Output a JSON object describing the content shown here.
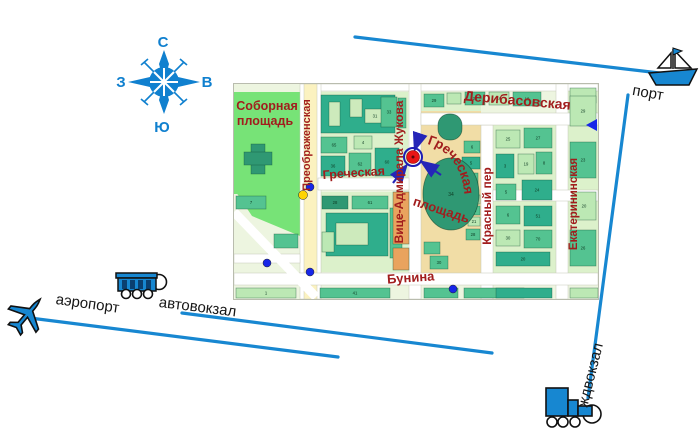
{
  "colors": {
    "route_blue": "#1787d1",
    "compass_blue": "#1080cf",
    "street_label_red": "#a11d1d",
    "marker_red": "#e81515",
    "marker_ring_blue": "#1c1cb4",
    "stop_dot_blue": "#1726e8",
    "stop_dot_yellow": "#ffd400",
    "square_beige": "#f1dda6",
    "park_green": "#77e377"
  },
  "compass": {
    "north": "С",
    "south": "Ю",
    "west": "З",
    "east": "В"
  },
  "transport": {
    "port": {
      "label": "порт",
      "icon": "ship-icon"
    },
    "airport": {
      "label": "аэропорт",
      "icon": "plane-icon"
    },
    "bus_station": {
      "label": "автовокзал",
      "icon": "bus-icon"
    },
    "rail_station": {
      "label": "ждвокзал",
      "icon": "train-icon"
    }
  },
  "connectors": [
    {
      "name": "port-line",
      "x1": 355,
      "y1": 37,
      "x2": 668,
      "y2": 74
    },
    {
      "name": "rail-line",
      "x1": 628,
      "y1": 95,
      "x2": 588,
      "y2": 398
    },
    {
      "name": "airport-line",
      "x1": 30,
      "y1": 318,
      "x2": 338,
      "y2": 357
    },
    {
      "name": "bus-line",
      "x1": 182,
      "y1": 313,
      "x2": 492,
      "y2": 353
    }
  ],
  "map": {
    "areas": [
      {
        "x": 0,
        "y": 0,
        "w": 364,
        "h": 215,
        "c": "#edf5e0"
      },
      {
        "x": 0,
        "y": 8,
        "w": 72,
        "h": 102,
        "c": "#77e377"
      },
      {
        "x": 84,
        "y": 8,
        "w": 90,
        "h": 88,
        "c": "#dcf1cb"
      },
      {
        "x": 84,
        "y": 108,
        "w": 90,
        "h": 80,
        "c": "#dcf1cb"
      },
      {
        "x": 187,
        "y": 8,
        "w": 60,
        "h": 19,
        "c": "#dcf1cb"
      },
      {
        "x": 187,
        "y": 27,
        "w": 60,
        "h": 163,
        "c": "#f1dda6"
      },
      {
        "x": 259,
        "y": 41,
        "w": 63,
        "h": 148,
        "c": "#dcf1cb"
      },
      {
        "x": 334,
        "y": 0,
        "w": 30,
        "h": 189,
        "c": "#dcf1cb"
      }
    ],
    "polygons": [
      {
        "points": "2,108 66,108 66,152 18,132",
        "c": "#77e377"
      }
    ],
    "roads": [
      {
        "x": 84,
        "y": 0,
        "w": 280,
        "h": 7
      },
      {
        "x": 66,
        "y": 0,
        "w": 21,
        "h": 215
      },
      {
        "x": 70,
        "y": 0,
        "w": 13,
        "h": 215,
        "c": "#fbf2c0"
      },
      {
        "x": 175,
        "y": 0,
        "w": 12,
        "h": 215
      },
      {
        "x": 247,
        "y": 41,
        "w": 12,
        "h": 174
      },
      {
        "x": 322,
        "y": 0,
        "w": 12,
        "h": 215
      },
      {
        "x": 187,
        "y": 29,
        "w": 177,
        "h": 12
      },
      {
        "x": 84,
        "y": 94,
        "w": 91,
        "h": 12
      },
      {
        "x": 259,
        "y": 106,
        "w": 105,
        "h": 11
      },
      {
        "x": 0,
        "y": 189,
        "w": 364,
        "h": 12
      },
      {
        "x": 0,
        "y": 170,
        "w": 66,
        "h": 9
      },
      {
        "diag": true,
        "x1": 0,
        "y1": 128,
        "x2": 82,
        "y2": 213,
        "sw": 9
      }
    ],
    "buildings": [
      [
        87,
        11,
        74,
        38,
        "#2fae8c",
        "38"
      ],
      [
        95,
        18,
        11,
        24,
        "#cdeabc",
        ""
      ],
      [
        116,
        15,
        12,
        18,
        "#cdeabc",
        ""
      ],
      [
        131,
        25,
        20,
        14,
        "#cdeabc",
        "31"
      ],
      [
        147,
        13,
        16,
        30,
        "#54c391",
        "33"
      ],
      [
        120,
        52,
        18,
        13,
        "#bce8b4",
        "4"
      ],
      [
        87,
        53,
        26,
        16,
        "#54c391",
        "65"
      ],
      [
        87,
        72,
        24,
        20,
        "#2fae8c",
        "36"
      ],
      [
        115,
        69,
        22,
        22,
        "#54c391",
        "62"
      ],
      [
        141,
        64,
        24,
        28,
        "#2fae8c",
        "60"
      ],
      [
        164,
        14,
        8,
        30,
        "#54c391",
        ""
      ],
      [
        88,
        112,
        26,
        13,
        "#2f9873",
        "28"
      ],
      [
        118,
        112,
        36,
        13,
        "#54c391",
        "61"
      ],
      [
        92,
        129,
        62,
        43,
        "#2fae8c",
        "42"
      ],
      [
        102,
        139,
        32,
        22,
        "#cdeabc",
        ""
      ],
      [
        88,
        148,
        12,
        20,
        "#bce8b4",
        ""
      ],
      [
        156,
        124,
        12,
        50,
        "#54c391",
        "16"
      ],
      [
        2,
        112,
        30,
        13,
        "#54c391",
        "7"
      ],
      [
        40,
        150,
        24,
        14,
        "#54c391",
        ""
      ],
      [
        190,
        10,
        20,
        13,
        "#54c391",
        "29"
      ],
      [
        213,
        9,
        14,
        11,
        "#bce8b4",
        ""
      ],
      [
        231,
        8,
        20,
        13,
        "#54c391",
        "22"
      ],
      [
        255,
        8,
        20,
        13,
        "#bce8b4",
        "16"
      ],
      [
        279,
        8,
        28,
        14,
        "#54c391",
        "10"
      ],
      [
        336,
        4,
        26,
        15,
        "#bce8b4",
        ""
      ],
      [
        230,
        57,
        16,
        12,
        "#54c391",
        "6"
      ],
      [
        228,
        73,
        18,
        12,
        "#2fae8c",
        "5"
      ],
      [
        224,
        89,
        20,
        12,
        "#54c391",
        "44"
      ],
      [
        234,
        111,
        12,
        9,
        "#bce8b4",
        "12"
      ],
      [
        234,
        122,
        12,
        9,
        "#54c391",
        "14"
      ],
      [
        234,
        133,
        12,
        9,
        "#bce8b4",
        "21"
      ],
      [
        232,
        145,
        14,
        11,
        "#54c391",
        "28"
      ],
      [
        190,
        158,
        16,
        12,
        "#54c391",
        ""
      ],
      [
        196,
        172,
        18,
        13,
        "#54c391",
        "30"
      ],
      [
        159,
        108,
        16,
        52,
        "#e9a35e",
        "2"
      ],
      [
        159,
        164,
        16,
        22,
        "#e9a35e",
        ""
      ],
      [
        262,
        46,
        24,
        18,
        "#bce8b4",
        "25"
      ],
      [
        290,
        44,
        28,
        20,
        "#54c391",
        "27"
      ],
      [
        262,
        70,
        18,
        24,
        "#2fae8c",
        "3"
      ],
      [
        284,
        70,
        16,
        20,
        "#bce8b4",
        "19"
      ],
      [
        302,
        68,
        16,
        22,
        "#54c391",
        "8"
      ],
      [
        262,
        100,
        20,
        16,
        "#54c391",
        "5"
      ],
      [
        288,
        96,
        30,
        20,
        "#2fae8c",
        "24"
      ],
      [
        262,
        122,
        24,
        18,
        "#54c391",
        "6"
      ],
      [
        290,
        122,
        28,
        20,
        "#2fae8c",
        "51"
      ],
      [
        262,
        146,
        24,
        16,
        "#bce8b4",
        "30"
      ],
      [
        290,
        146,
        28,
        18,
        "#54c391",
        "70"
      ],
      [
        262,
        168,
        54,
        14,
        "#2fae8c",
        "20"
      ],
      [
        336,
        12,
        26,
        30,
        "#bce8b4",
        "29"
      ],
      [
        336,
        58,
        26,
        36,
        "#54c391",
        "23"
      ],
      [
        338,
        108,
        24,
        28,
        "#bce8b4",
        "20"
      ],
      [
        336,
        146,
        26,
        36,
        "#54c391",
        "26"
      ],
      [
        2,
        204,
        60,
        10,
        "#bce8b4",
        "1"
      ],
      [
        86,
        204,
        70,
        10,
        "#54c391",
        "41"
      ],
      [
        190,
        204,
        34,
        10,
        "#54c391",
        ""
      ],
      [
        230,
        204,
        60,
        10,
        "#54c391",
        ""
      ],
      [
        262,
        204,
        56,
        10,
        "#2fae8c",
        ""
      ],
      [
        336,
        204,
        28,
        10,
        "#bce8b4",
        ""
      ],
      [
        17,
        60,
        14,
        30,
        "#2f9873",
        "3"
      ],
      [
        10,
        68,
        28,
        13,
        "#2f9873",
        ""
      ]
    ],
    "shapes": {
      "stadium": {
        "x": 204,
        "y": 30,
        "w": 24,
        "h": 26,
        "rx": 11,
        "c": "#2f9873"
      },
      "oval": {
        "cx": 217,
        "cy": 110,
        "rx": 28,
        "ry": 36,
        "c": "#2f9873",
        "n": "34"
      }
    },
    "dots": [
      {
        "x": 76,
        "y": 103,
        "r": 4,
        "c": "#1726e8"
      },
      {
        "x": 69,
        "y": 111,
        "r": 4.5,
        "c": "#ffd400"
      },
      {
        "x": 33,
        "y": 179,
        "r": 4,
        "c": "#1726e8"
      },
      {
        "x": 76,
        "y": 188,
        "r": 4,
        "c": "#1726e8"
      },
      {
        "x": 219,
        "y": 205,
        "r": 4,
        "c": "#1726e8"
      }
    ],
    "direction_triangle": {
      "points": "352,41 363,35 363,47",
      "c": "#1726e8"
    },
    "marker": {
      "cx": 179,
      "cy": 73,
      "fill": "#e81515",
      "ring": "#1c1cb4"
    },
    "marker_arrows": [
      [
        186,
        50,
        181,
        65
      ],
      [
        159,
        99,
        172,
        82
      ],
      [
        207,
        91,
        188,
        78
      ]
    ],
    "street_labels": [
      {
        "t": "Соборная",
        "x": 33,
        "y": 26,
        "s": 12.5,
        "r": 0
      },
      {
        "t": "площадь",
        "x": 31,
        "y": 41,
        "s": 12.5,
        "r": 0
      },
      {
        "t": "Преображенская",
        "x": 76,
        "y": 61,
        "s": 11,
        "r": -90
      },
      {
        "t": "Дерибасовская",
        "x": 283,
        "y": 21,
        "s": 14,
        "r": 5
      },
      {
        "t": "Греческая",
        "x": 120,
        "y": 93,
        "s": 12.5,
        "r": -4
      },
      {
        "t": "Вице-Адмирала Жукова",
        "x": 169,
        "y": 88,
        "s": 12,
        "r": -90
      },
      {
        "t": "площадь",
        "x": 206,
        "y": 130,
        "s": 13,
        "r": 18
      },
      {
        "t": "Красный пер",
        "x": 257,
        "y": 122,
        "s": 12,
        "r": -90
      },
      {
        "t": "Екатерининская",
        "x": 343,
        "y": 120,
        "s": 11.5,
        "r": -90
      },
      {
        "t": "Бунина",
        "x": 177,
        "y": 198,
        "s": 13,
        "r": -4
      }
    ],
    "curved_label": {
      "t": "Греческая",
      "path": "M 193,60 C 223,68 237,100 228,142",
      "s": 13.5
    }
  }
}
